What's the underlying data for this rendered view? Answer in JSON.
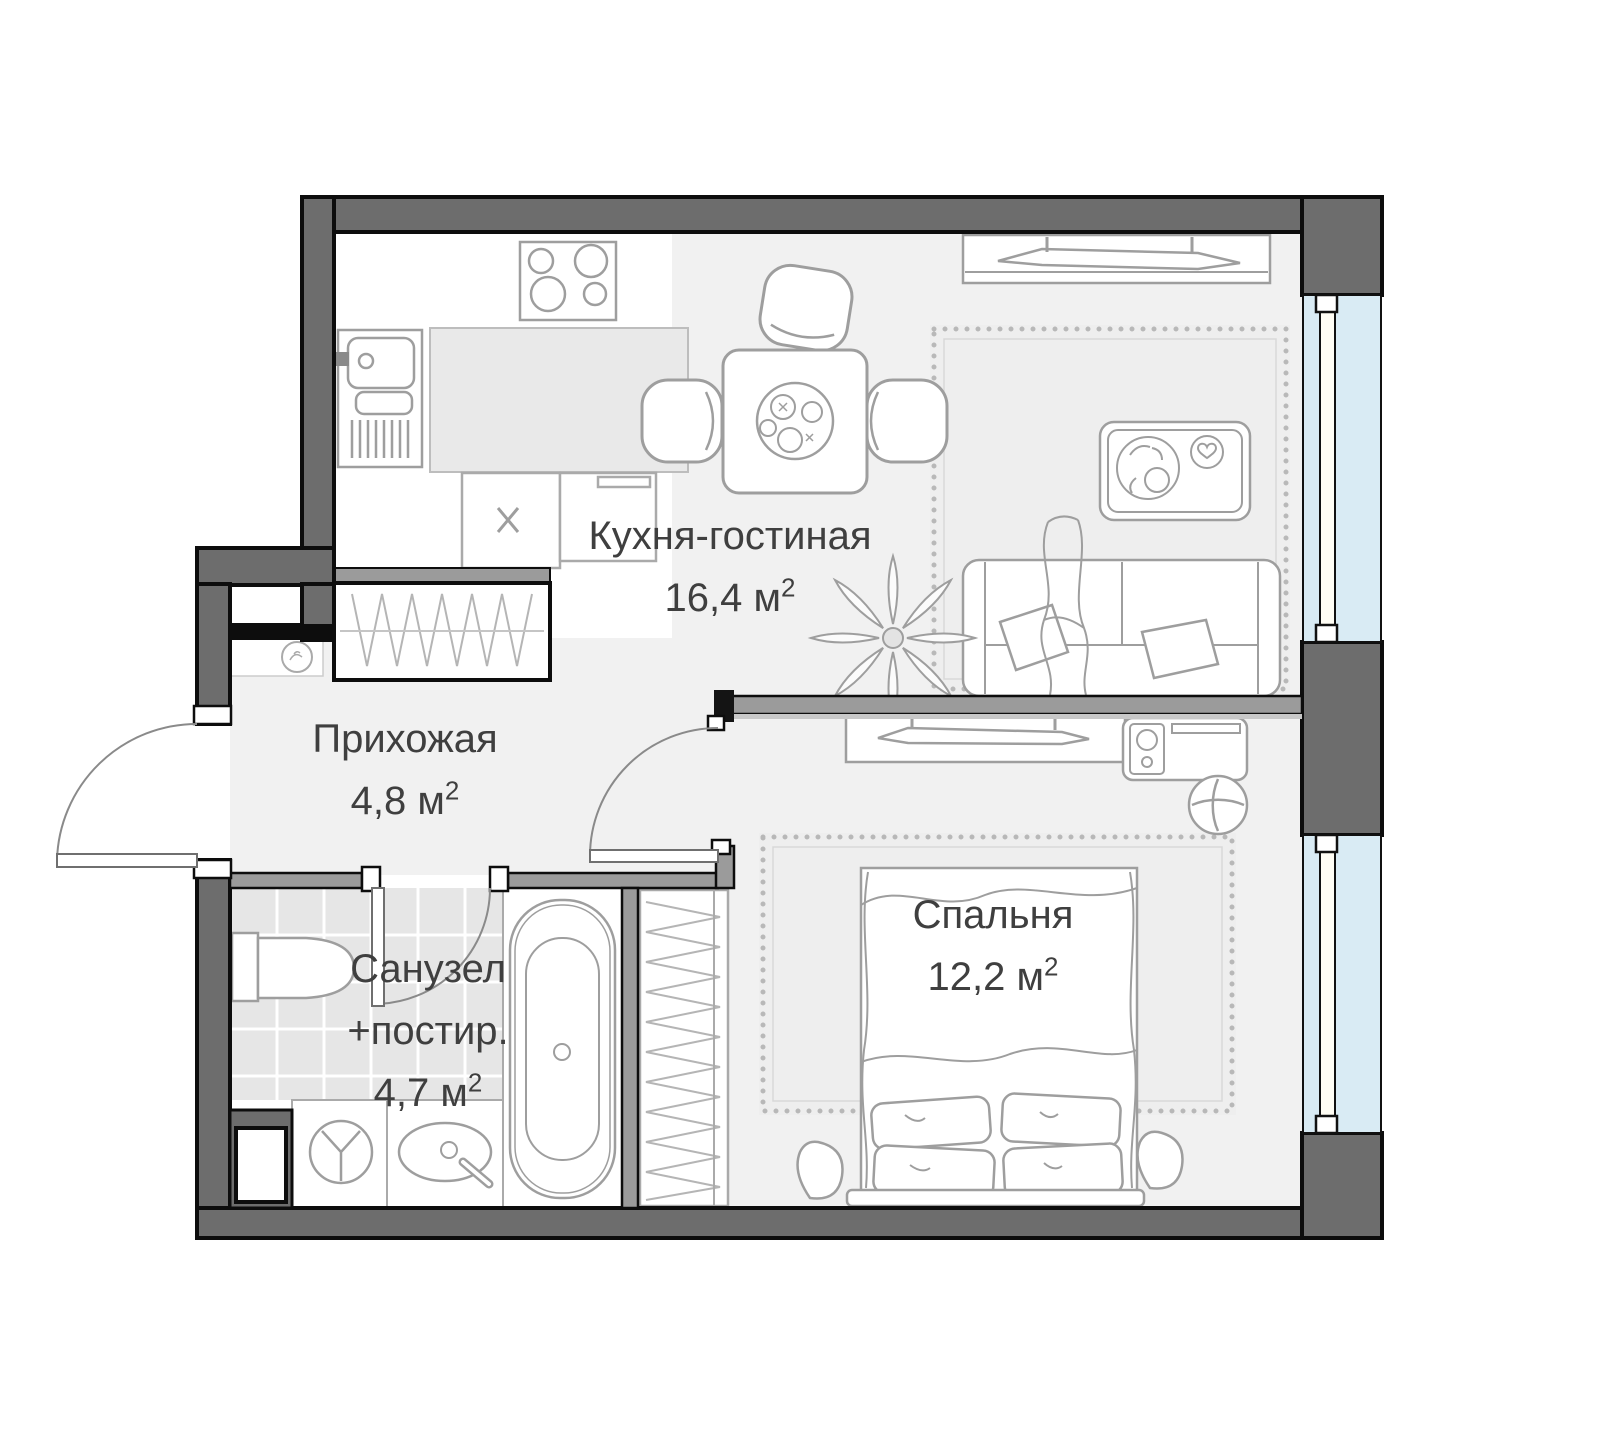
{
  "rooms": [
    {
      "name": "kitchen-living-room",
      "label": "Кухня-гостиная",
      "area": "16,4",
      "unit": " м",
      "power": "2"
    },
    {
      "name": "hallway",
      "label": "Прихожая",
      "area": "4,8",
      "unit": " м",
      "power": "2"
    },
    {
      "name": "bathroom-laundry",
      "label": "Санузел",
      "label2": "+постир.",
      "area": "4,7",
      "unit": " м",
      "power": "2"
    },
    {
      "name": "bedroom",
      "label": "Спальня",
      "area": "12,2",
      "unit": " м",
      "power": "2"
    }
  ],
  "colors": {
    "outer_wall": "#6d6d6d",
    "partition_wall": "#9b9b9b",
    "wall_outline": "#0d0d0d",
    "floor": "#f1f1f1",
    "tile": "#e6e6e6",
    "counter": "#e9e9e9",
    "window_glass": "#d9ebf4",
    "furniture_stroke": "#9e9e9e",
    "label_text": "#3f3f3f"
  },
  "fixtures": [
    "stove-icon",
    "kitchen-sink-icon",
    "dishwasher-icon",
    "dining-table-icon",
    "chair-icon",
    "tv-console-icon",
    "sofa-icon",
    "coffee-table-icon",
    "plant-icon",
    "rug-icon",
    "closet-icon",
    "wardrobe-icon",
    "toilet-icon",
    "washing-machine-icon",
    "washbasin-icon",
    "bathtub-icon",
    "bed-icon",
    "nightstand-icon",
    "desk-icon",
    "stool-icon",
    "window-icon",
    "door-icon",
    "niche-icon"
  ]
}
